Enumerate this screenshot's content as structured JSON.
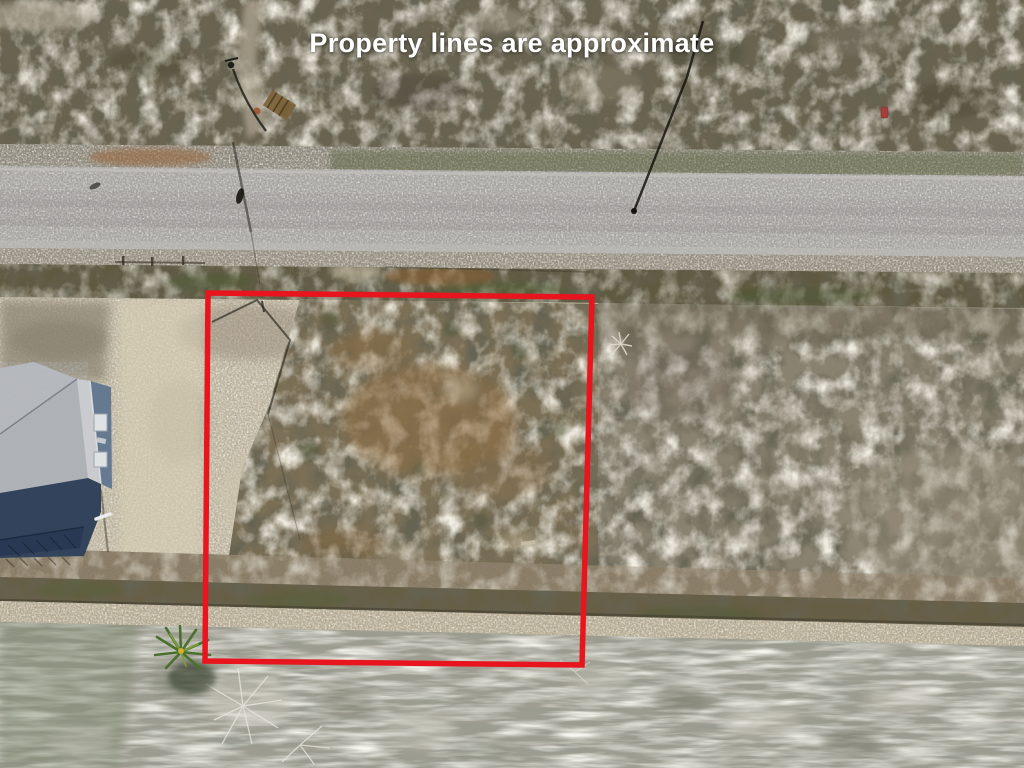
{
  "caption": {
    "text": "Property lines are approximate"
  },
  "overlay": {
    "outline_color": "#e8141e",
    "outline_shape": "property-boundary-rectangle"
  },
  "palette": {
    "top_scrub": "#6a6350",
    "road": "#acaaa7",
    "open_sand": "#c5bba3",
    "lot_scrub": "#7b6f56",
    "right_scrub": "#8a8271",
    "dry_grass": "#9d9c90",
    "house_roof": "#b6b9bd",
    "house_wall": "#657a91",
    "deck_shadow": "#33435c"
  }
}
